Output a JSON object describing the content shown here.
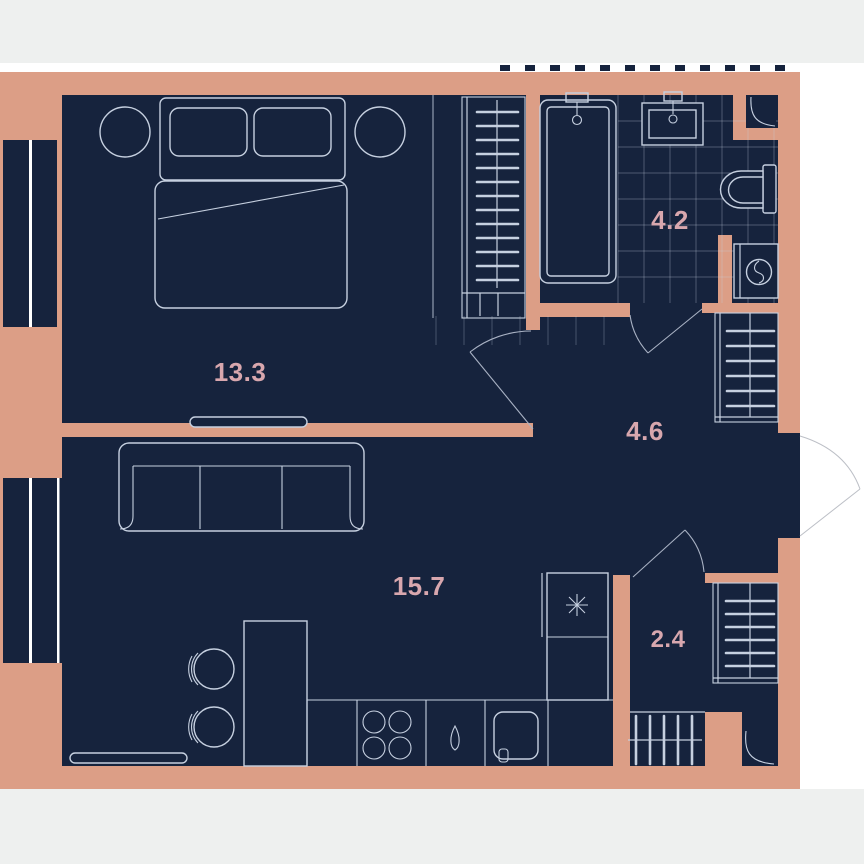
{
  "page": {
    "background_color": "#ffffff",
    "letterbox_band_color": "#eef0ef"
  },
  "plan": {
    "type": "apartment-floor-plan",
    "wall_color": "#dc9e86",
    "floor_color": "#16233d",
    "furniture_line_color": "#c6d0e0",
    "label_color": "#d8a7ae",
    "rooms": [
      {
        "id": "bedroom",
        "area_label": "13.3",
        "features": [
          "double-bed",
          "two-pillows",
          "round-nightstand-left",
          "round-nightstand-right",
          "wardrobe-with-hangers",
          "tv-console",
          "window"
        ]
      },
      {
        "id": "bathroom",
        "area_label": "4.2",
        "features": [
          "bathtub",
          "wash-basin",
          "toilet",
          "washing-machine",
          "tile-grid",
          "corner-duct"
        ]
      },
      {
        "id": "hallway",
        "area_label": "4.6",
        "features": [
          "coat-rack",
          "entrance-door",
          "interior-doors"
        ]
      },
      {
        "id": "living-kitchen",
        "area_label": "15.7",
        "features": [
          "sofa",
          "dining-table",
          "two-chairs",
          "kitchen-counter",
          "four-burner-hob",
          "sink-drop-icon",
          "refrigerator-snowflake-icon",
          "tv-console",
          "window"
        ]
      },
      {
        "id": "wardrobe-room",
        "area_label": "2.4",
        "features": [
          "hanger-rack-side",
          "hanger-rack-bottom",
          "corner-duct"
        ]
      }
    ]
  }
}
